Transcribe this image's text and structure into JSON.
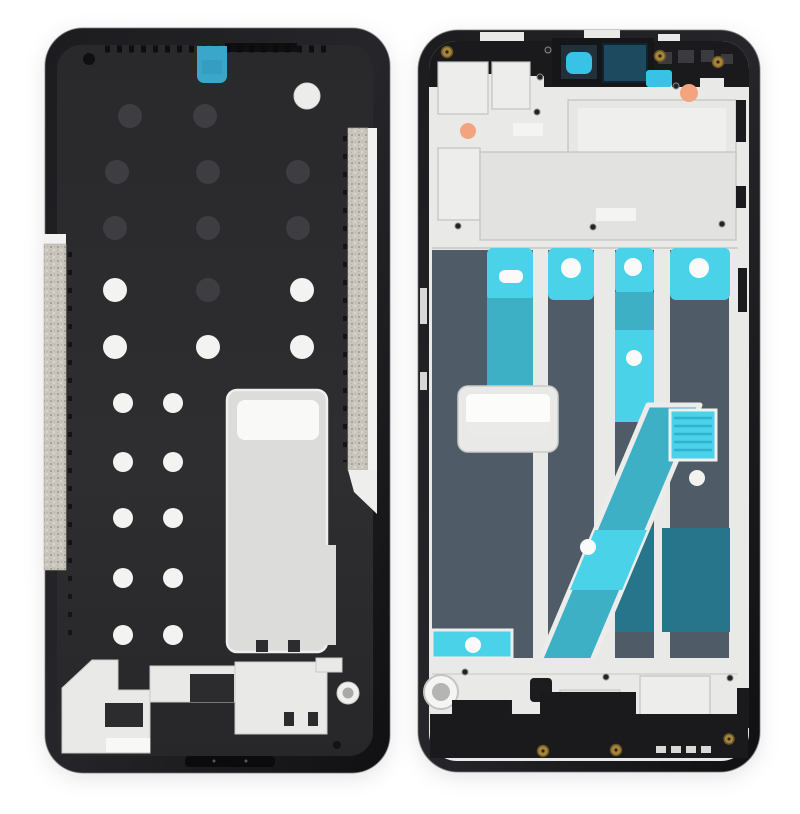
{
  "scene": {
    "type": "product-photo",
    "subject": "smartphone-front-housing-lcd-frame-bezel-two-views",
    "views": [
      {
        "id": "front-view",
        "side": "display-side",
        "finish": "matte-black-with-alignment-holes"
      },
      {
        "id": "back-view",
        "side": "inner-side",
        "finish": "silver-metal-with-cyan-adhesive-strips"
      }
    ],
    "icon_parts": [
      "camera-hole-icon",
      "earpiece-mesh-icon",
      "screw-icon",
      "adhesive-strip",
      "alignment-hole",
      "speaker-cutout",
      "mic-hole"
    ]
  },
  "colors": {
    "page_bg": "#ffffff",
    "frame_black": "#1a1a1c",
    "frame_edge": "#77777a",
    "cavity": "#2c2c2e",
    "dot_dark": "#3e3e42",
    "dot_white": "#f3f3f1",
    "hole_white": "#ececea",
    "silver": "#e9e9e7",
    "silver_bright": "#f8f8f6",
    "silver_mid": "#dcdcda",
    "outline_gray": "#c2c2c0",
    "grain": "#cac6bd",
    "grain_dark": "#a39f95",
    "slate": "#4f5b67",
    "cyan_bright": "#4ad2e9",
    "cyan_mid": "#3eb0c6",
    "teal_dark": "#27758a",
    "teal_navy": "#1d4a5e",
    "cyan_sticker": "#3aa6ca",
    "cam_cyan": "#38c2e6",
    "orange": "#f3a47f",
    "gold": "#a5853e",
    "gold_dark": "#6b5524",
    "screw_black": "#232325"
  }
}
